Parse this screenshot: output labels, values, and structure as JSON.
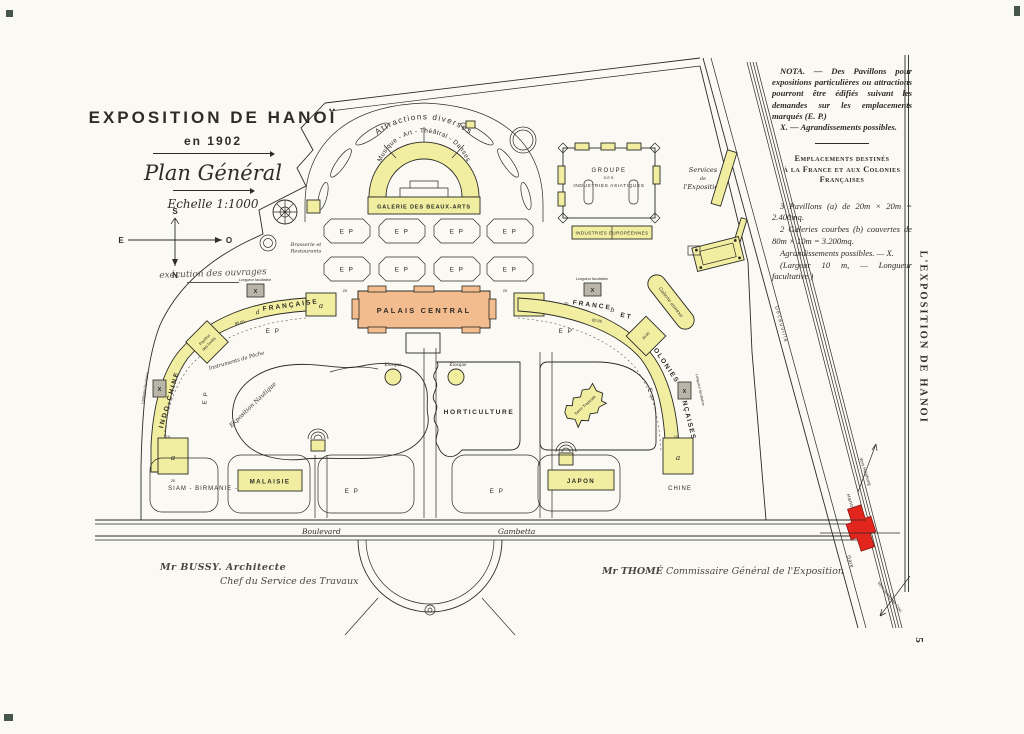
{
  "header": {
    "title": "EXPOSITION DE HANOÏ",
    "year": "en 1902",
    "plan": "Plan Général",
    "scale": "Echelle 1:1000",
    "note": "exécution des ouvrages"
  },
  "compass": {
    "s": "S",
    "n": "N",
    "e": "E",
    "o": "O"
  },
  "nota": {
    "p1": "NOTA. — Des Pavillons pour expositions particulières ou attractions pourront être édifiés suivant les demandes sur les emplacements marqués (E. P.)",
    "p2": "X. — Agrandissements possibles.",
    "dest1": "Emplacements destinés",
    "dest2": "à la France et aux Colonies Françaises",
    "s1": "3 Pavillons (a) de 20m × 20m = 2.400mq.",
    "s2": "2 Galeries courbes (b) couvertes de 80m × 10m = 3.200mq.",
    "s3": "Agrandissements possibles. — X.",
    "s4": "(Largeur 10 m, — Longueur facultative.)"
  },
  "map": {
    "attractions": "Attractions diverses",
    "musique": "Musique - Art - Théâtral - Danses",
    "beaux_arts": "GALERIE DES BEAUX-ARTS",
    "brasserie1": "Brasserie et",
    "brasserie2": "Restaurants",
    "groupe1": "GROUPE",
    "groupe2": "DES",
    "groupe3": "INDUSTRIES ASIATIQUES",
    "industries_eu": "INDUSTRIES EUROPÉENNES",
    "services1": "Services",
    "services2": "de",
    "services3": "l'Exposition",
    "palais": "PALAIS CENTRAL",
    "francaise": "FRANÇAISE",
    "indochine": "INDO-CHINE",
    "pavillon_forets1": "Pavillon",
    "pavillon_forets2": "des forêts",
    "france": "FRANCE",
    "b": "b",
    "et": "ET",
    "colonies": "COLONIES",
    "colonies2": "FRANÇAISES",
    "galerie_annexe": "Galerie annexe",
    "longueur": "Longueur facultative",
    "expo_nautique": "Exposition Nautique",
    "instruments": "Instruments de Pêche",
    "kiosque": "Kiosque",
    "horticulture": "HORTICULTURE",
    "serre": "Serre Tropicale",
    "siam": "SIAM  -  BIRMANIE  -",
    "malaisie": "MALAISIE",
    "japon": "JAPON",
    "chine": "CHINE",
    "ep": "E P",
    "a": "a",
    "d": "d",
    "x": "X",
    "d80": "80.00",
    "d30": "30.00",
    "d10": "10",
    "d20": "20",
    "boulevard": "Boulevard",
    "gambetta": "Gambetta",
    "gare": "Gare",
    "hanoi": "Hanoï",
    "vers_haiphong": "Vers Haïphong",
    "vers_pont": "Vers (pont) de Cou.",
    "decauville": "Decauville"
  },
  "signatures": {
    "left1": "Mr BUSSY. Architecte",
    "left2": "Chef du Service des Travaux",
    "right1": "Mr THOMÉ",
    "right2": "Commissaire Général de l'Exposition"
  },
  "margin": {
    "side_title": "L'EXPOSITION DE HANOI",
    "page": "5"
  },
  "colors": {
    "yellow": "#f1eda1",
    "palais_orange": "#f3bc8e",
    "gare_red": "#e2261d",
    "paper": "#faf9f4"
  }
}
